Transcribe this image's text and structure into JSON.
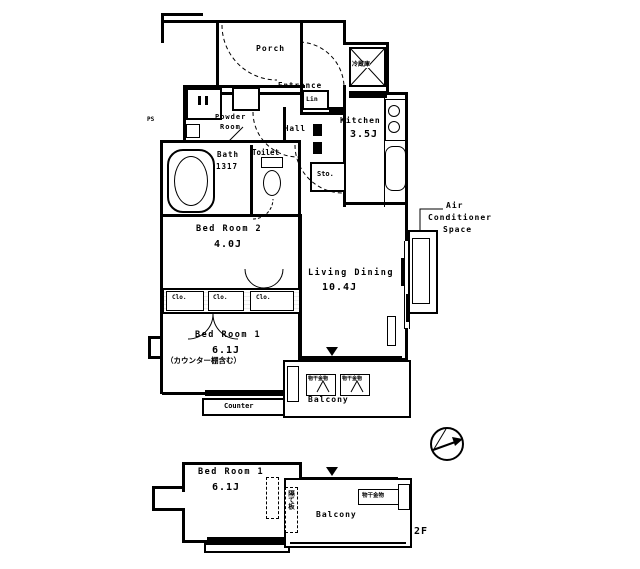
{
  "floorplan": {
    "rooms": {
      "porch": {
        "name": "Porch"
      },
      "entrance": {
        "name": "Entrance"
      },
      "linen": {
        "name": "Lin"
      },
      "powder_room": {
        "name_line1": "Powder",
        "name_line2": "Room"
      },
      "bath": {
        "name": "Bath",
        "size": "1317"
      },
      "toilet": {
        "name": "Toilet"
      },
      "hall": {
        "name": "Hall"
      },
      "storage": {
        "name": "Sto."
      },
      "kitchen": {
        "name": "Kitchen",
        "area": "3.5J"
      },
      "bedroom2": {
        "name": "Bed Room 2",
        "area": "4.0J"
      },
      "living_dining": {
        "name": "Living Dining",
        "area": "10.4J"
      },
      "bedroom1": {
        "name": "Bed Room 1",
        "area": "6.1J",
        "note": "（カウンター棚含む）"
      },
      "counter": {
        "name": "Counter"
      },
      "balcony_1f": {
        "name": "Balcony"
      },
      "bedroom1_2f": {
        "name": "Bed Room 1",
        "area": "6.1J"
      },
      "balcony_2f": {
        "name": "Balcony"
      }
    },
    "labels": {
      "ac_line1": "Air",
      "ac_line2": "Conditioner",
      "ac_line3": "Space",
      "refrigerator": "冷蔵庫",
      "closet_abbr": "Clo.",
      "laundry_hardware": "物干金物",
      "partition_board": "隔て板",
      "pipe_space": "PS",
      "floor": "2F"
    },
    "colors": {
      "line": "#000000",
      "background": "#ffffff"
    }
  }
}
